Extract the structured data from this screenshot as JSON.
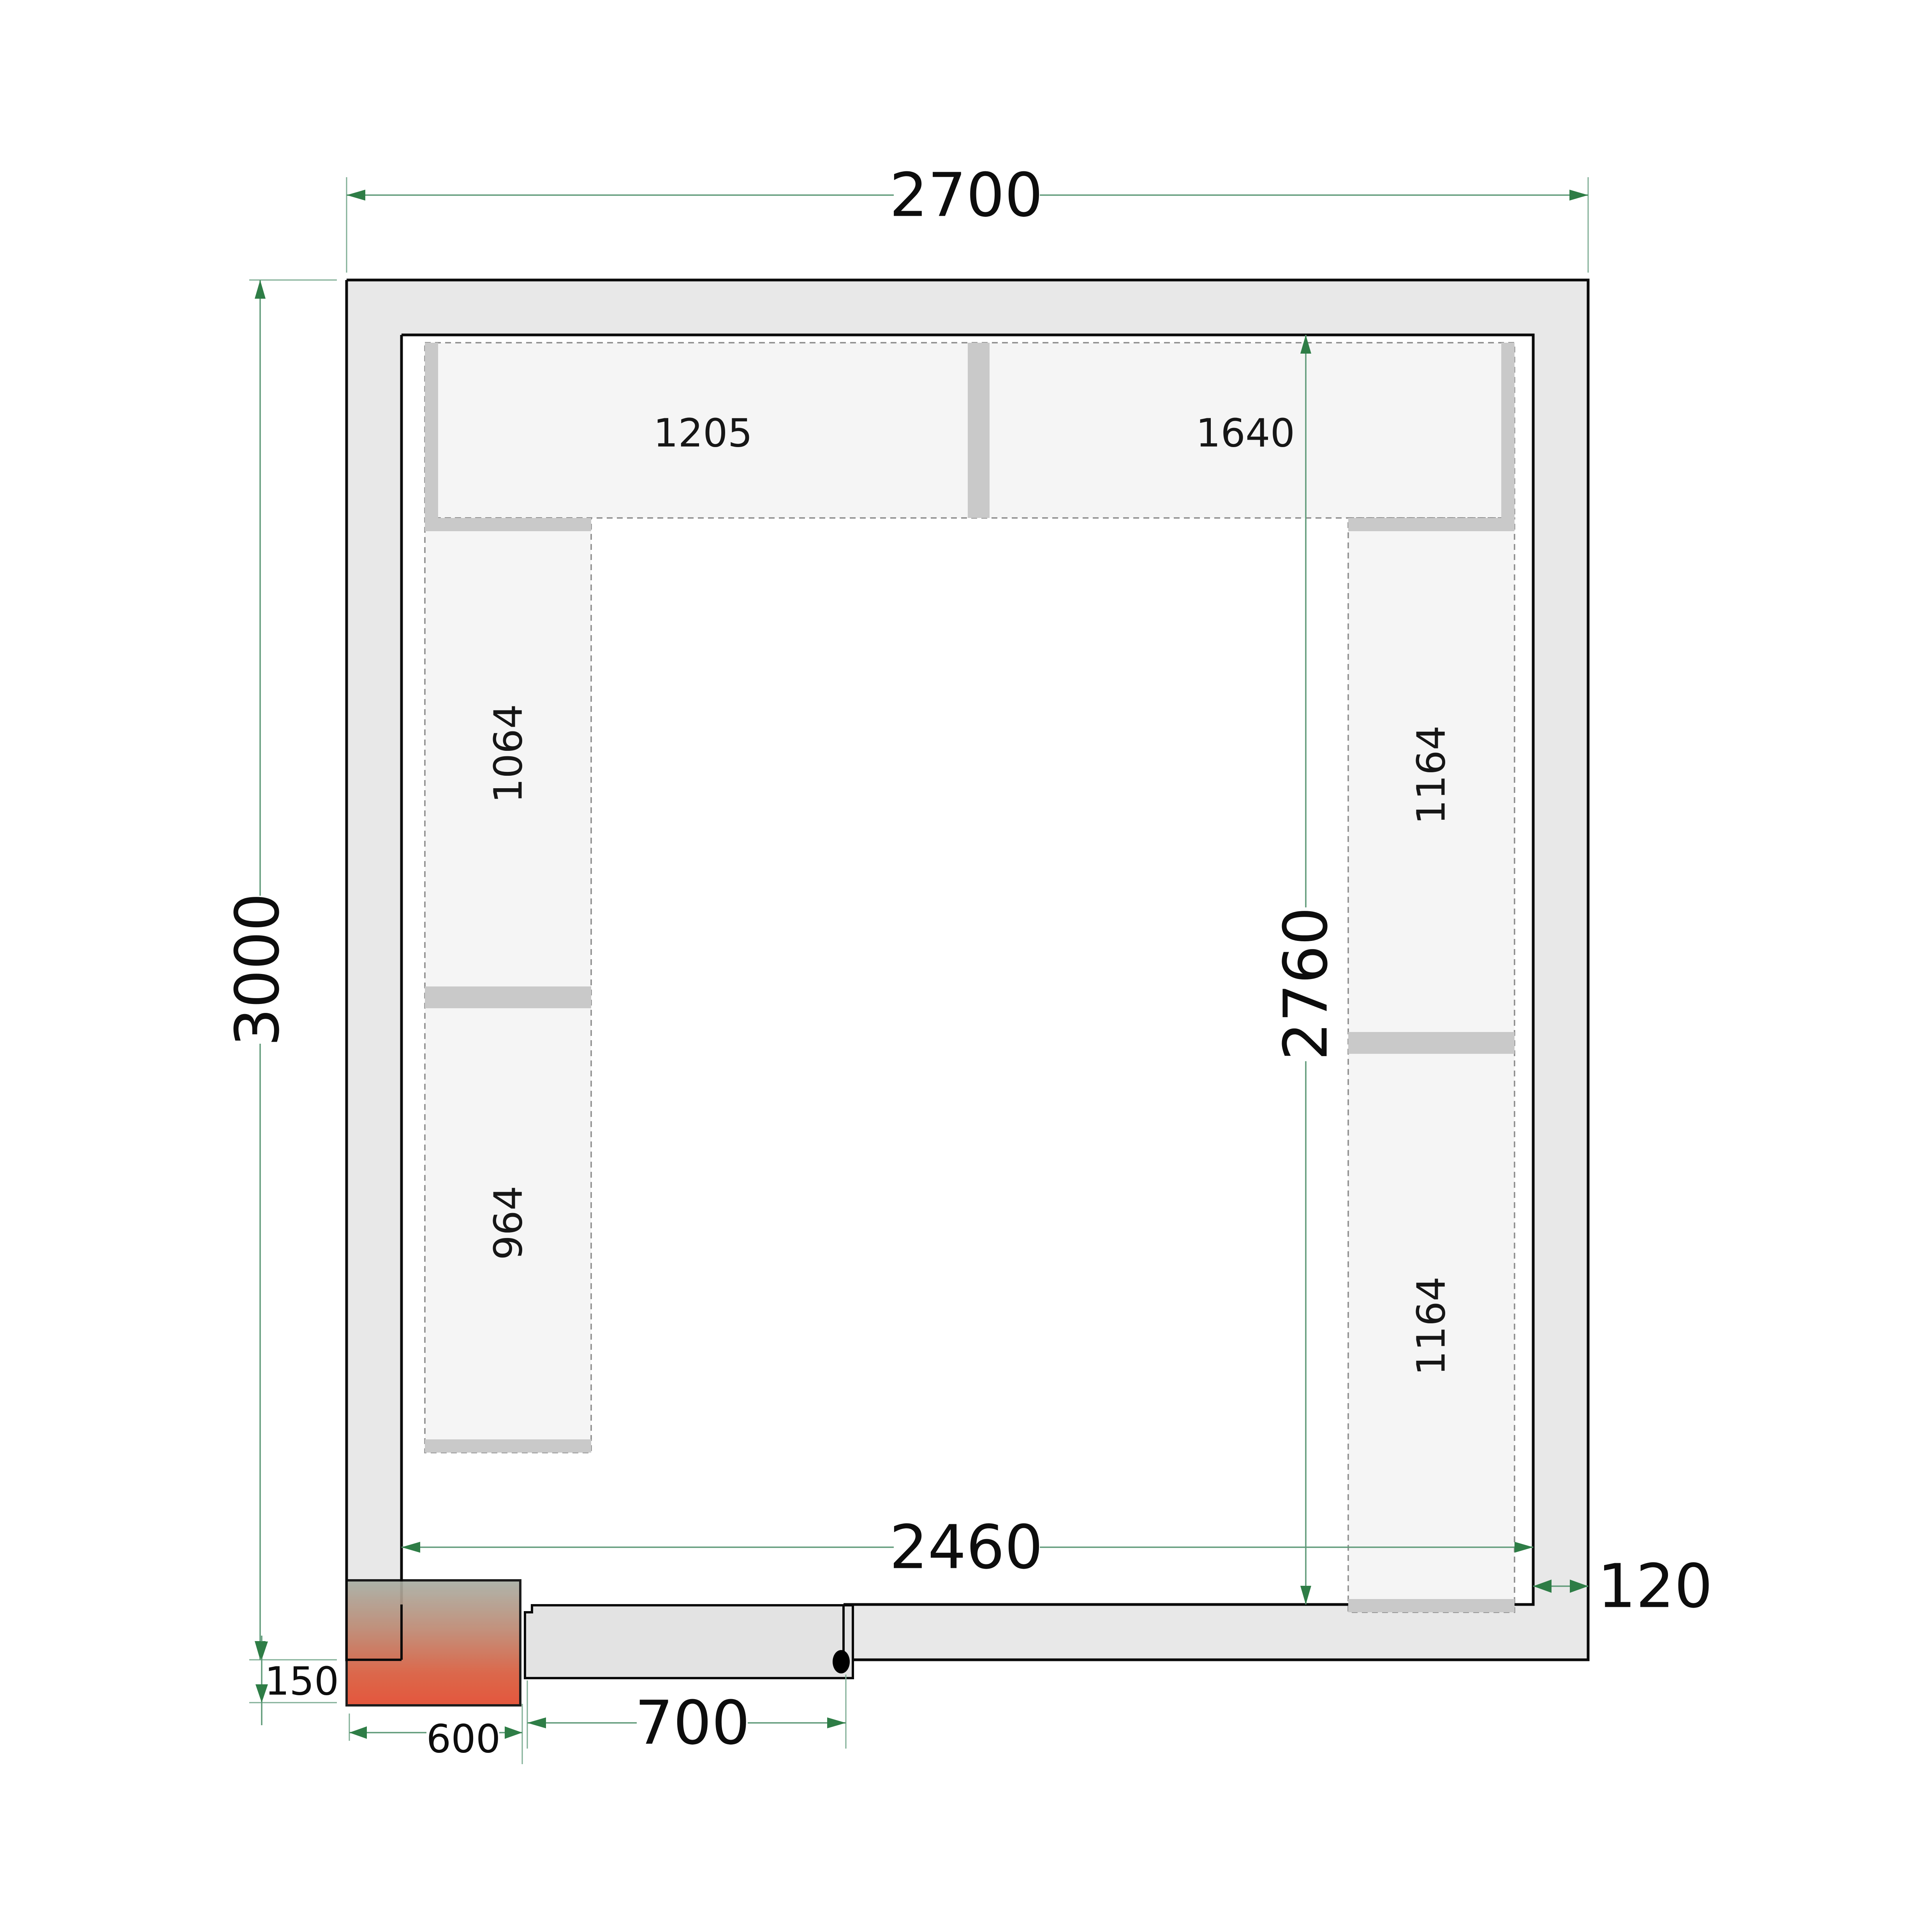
{
  "drawing": {
    "type": "cold-room floor plan",
    "dimensions": {
      "outer_width": "2700",
      "outer_height": "3000",
      "inner_width": "2460",
      "inner_height": "2760",
      "wall_thickness": "120",
      "unit_offset": "150",
      "unit_width": "600",
      "door_width": "700"
    },
    "shelf_labels": {
      "top_left": "1205",
      "top_right": "1640",
      "left_upper": "1064",
      "left_lower": "964",
      "right_upper": "1164",
      "right_lower": "1164"
    },
    "colors": {
      "wall_fill": "#e8e8e8",
      "shelf_fill": "#f5f5f5",
      "shelf_cap": "#c9c9c9",
      "outline": "#0a0a0a",
      "dimension_line": "#5f9a78",
      "dimension_arrow": "#2e7d46",
      "condensing_unit_red": "#e2492d",
      "door_fill": "#e3e3e3"
    }
  }
}
